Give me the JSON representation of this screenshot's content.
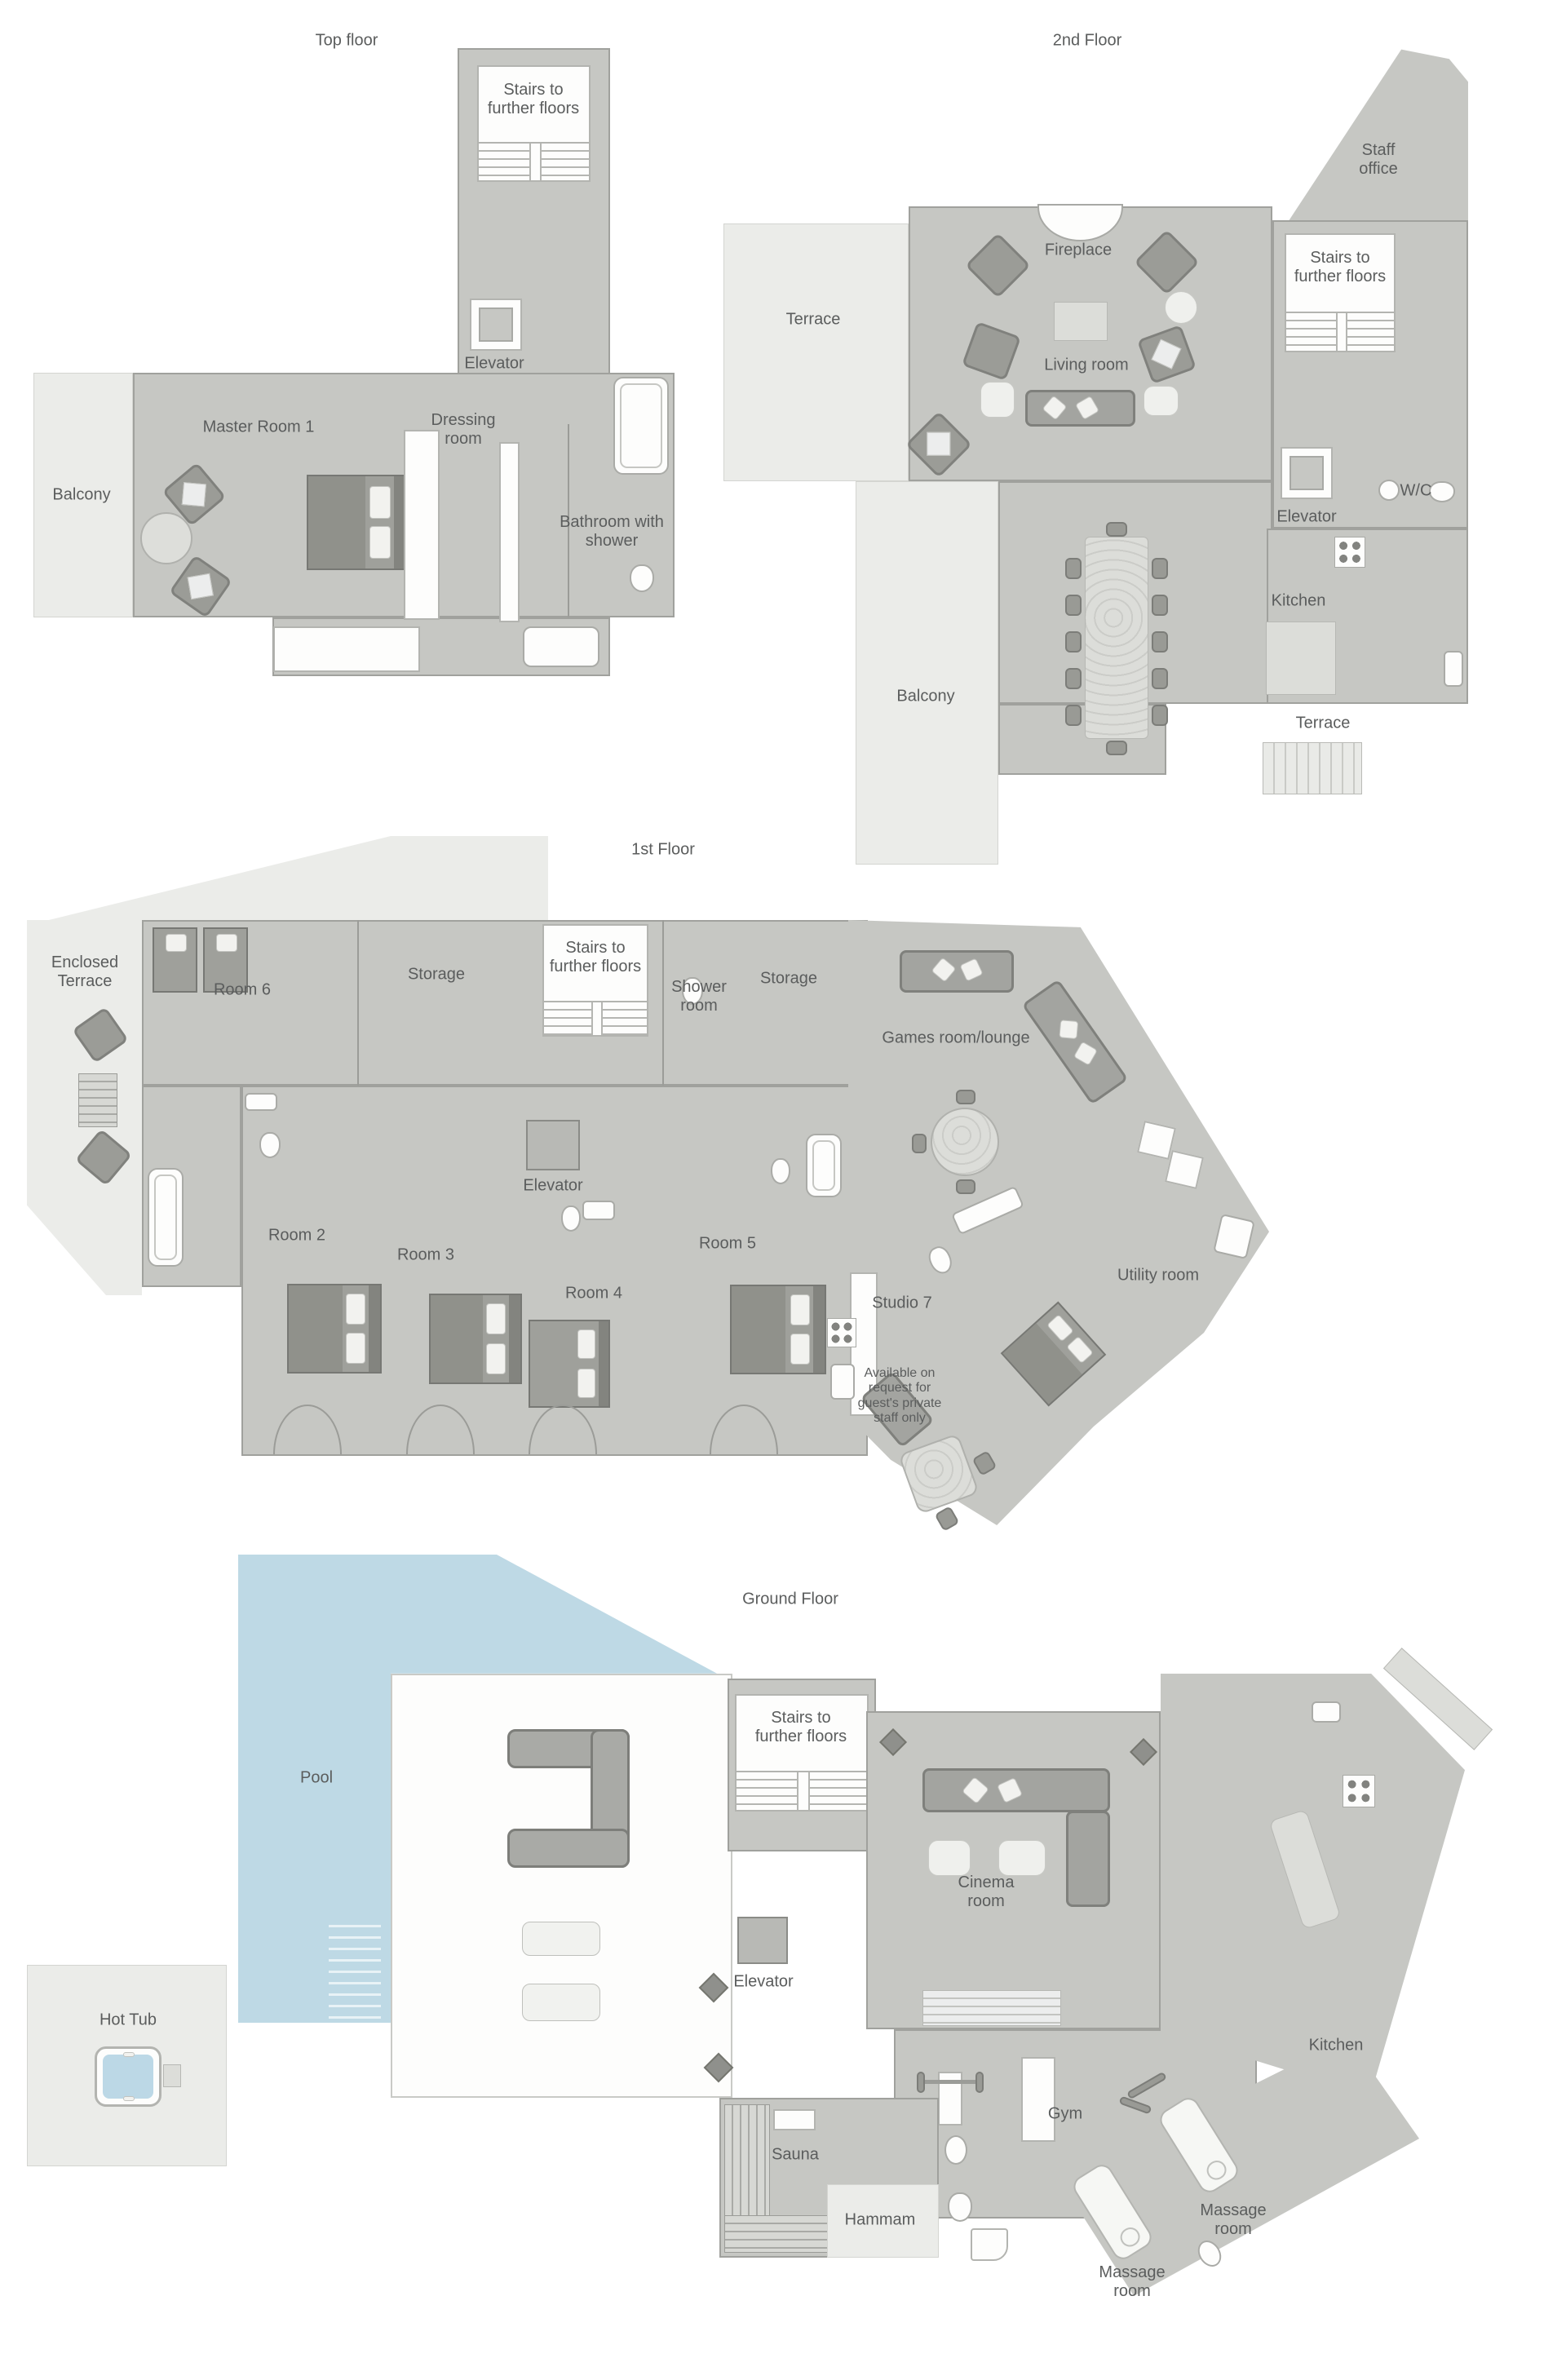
{
  "document": {
    "type": "villa-floor-plan",
    "floors_count": 4
  },
  "common": {
    "stairs": "Stairs to further floors",
    "elevator": "Elevator",
    "terrace": "Terrace",
    "balcony": "Balcony",
    "kitchen": "Kitchen",
    "storage": "Storage",
    "massage_room": "Massage room"
  },
  "floors": {
    "top": {
      "title": "Top floor",
      "master": "Master Room 1",
      "dressing": "Dressing room",
      "bathroom": "Bathroom with shower"
    },
    "second": {
      "title": "2nd Floor",
      "staff_office": "Staff office",
      "fireplace": "Fireplace",
      "living": "Living room",
      "wc": "W/C"
    },
    "first": {
      "title": "1st Floor",
      "enclosed_terrace": "Enclosed Terrace",
      "room6": "Room 6",
      "shower_room": "Shower room",
      "games": "Games room/lounge",
      "room2": "Room 2",
      "room3": "Room 3",
      "room4": "Room 4",
      "room5": "Room 5",
      "studio7": "Studio 7",
      "utility": "Utility room",
      "note": "Available on request for guest's private staff only"
    },
    "ground": {
      "title": "Ground Floor",
      "pool": "Pool",
      "hot_tub": "Hot Tub",
      "cinema": "Cinema room",
      "gym": "Gym",
      "sauna": "Sauna",
      "hammam": "Hammam"
    }
  },
  "colors": {
    "room_fill": "#c6c7c3",
    "terrace_fill": "#ebece9",
    "wall": "#9b9c98",
    "pool_fill": "#bed9e5",
    "hot_tub_water": "#bcd8e6",
    "furniture_dark": "#999a95",
    "fixture_white": "#fdfdfc",
    "text": "#5b5d5d"
  }
}
